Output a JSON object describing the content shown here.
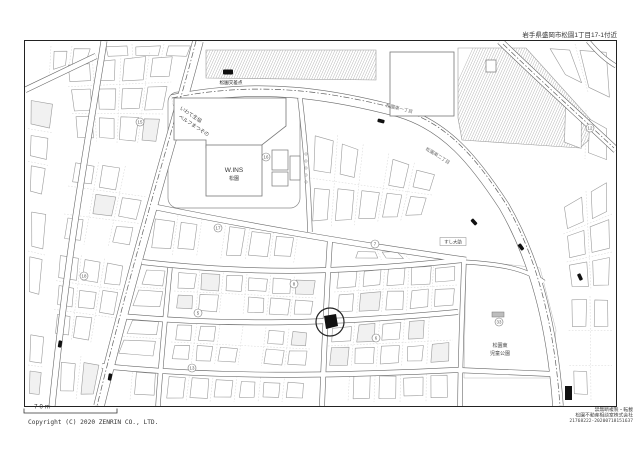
{
  "page": {
    "header_address": "岩手県盛岡市松園1丁目17-1付近",
    "scale_label": "70m",
    "copyright": "Copyright (C) 2020 ZENRIN CO., LTD.",
    "footer_right": {
      "line1": "禁無断複製・転載",
      "line2": "松園不動産相談室株式会社",
      "line3": "21768222-20200718151637"
    }
  },
  "map": {
    "colors": {
      "road_edge": "#686868",
      "building_outline": "#9b9b9b",
      "named_building_outline": "#777777",
      "lot_line": "#c9c9c9",
      "boundary_line": "#5f5f5f",
      "hatch": "#a8a8a8",
      "label_text": "#444444",
      "road_label_text": "#6b6b6b",
      "marker_black": "#111111",
      "frame": "#222222"
    },
    "labels": [
      {
        "id": "intersection-name",
        "text": "松園交差点",
        "x": 231,
        "y": 84,
        "size": 4.6,
        "rot": 0,
        "color": "#222222"
      },
      {
        "id": "coop-line1",
        "text": "いわて生協",
        "x": 190,
        "y": 116,
        "size": 5,
        "rot": 33,
        "color": "#444444"
      },
      {
        "id": "coop-line2",
        "text": "ベルフまつぞの",
        "x": 193,
        "y": 127,
        "size": 5,
        "rot": 33,
        "color": "#444444"
      },
      {
        "id": "wins-line1",
        "text": "W.INS",
        "x": 234,
        "y": 172,
        "size": 6.5,
        "rot": 0,
        "color": "#333333"
      },
      {
        "id": "wins-line2",
        "text": "松園",
        "x": 234,
        "y": 180,
        "size": 5,
        "rot": 0,
        "color": "#333333"
      },
      {
        "id": "road-name-1",
        "text": "松園東一丁目",
        "x": 399,
        "y": 110,
        "size": 4.6,
        "rot": 14,
        "color": "#6b6b6b"
      },
      {
        "id": "road-name-2",
        "text": "松園東二丁目",
        "x": 437,
        "y": 157,
        "size": 4.6,
        "rot": 32,
        "color": "#6b6b6b"
      },
      {
        "id": "sushi-daisuke",
        "text": "すし大助",
        "x": 453,
        "y": 243.5,
        "size": 4.4,
        "rot": 0,
        "color": "#333333",
        "boxed": true
      },
      {
        "id": "park-name-1",
        "text": "松園東",
        "x": 500,
        "y": 347,
        "size": 5,
        "rot": 0,
        "color": "#444444"
      },
      {
        "id": "park-name-2",
        "text": "児童公園",
        "x": 500,
        "y": 355,
        "size": 5,
        "rot": 0,
        "color": "#444444"
      }
    ],
    "block_numbers": [
      {
        "n": "15",
        "x": 140,
        "y": 122
      },
      {
        "n": "16",
        "x": 266,
        "y": 157
      },
      {
        "n": "17",
        "x": 218,
        "y": 228
      },
      {
        "n": "18",
        "x": 84,
        "y": 276
      },
      {
        "n": "7",
        "x": 375,
        "y": 244
      },
      {
        "n": "8",
        "x": 294,
        "y": 284
      },
      {
        "n": "5",
        "x": 198,
        "y": 313
      },
      {
        "n": "13",
        "x": 192,
        "y": 368
      },
      {
        "n": "33",
        "x": 499,
        "y": 322
      },
      {
        "n": "12",
        "x": 590,
        "y": 128
      },
      {
        "n": "6",
        "x": 376,
        "y": 338
      }
    ],
    "bus_stops": [
      {
        "x": 381,
        "y": 121,
        "rot": 14
      },
      {
        "x": 474,
        "y": 222,
        "rot": 48
      },
      {
        "x": 521,
        "y": 247,
        "rot": 55
      },
      {
        "x": 580,
        "y": 277,
        "rot": 65
      },
      {
        "x": 60,
        "y": 344,
        "rot": -80
      },
      {
        "x": 110,
        "y": 377,
        "rot": -80
      }
    ],
    "intersection_icon": {
      "x": 228,
      "y": 72
    },
    "target_marker": {
      "x": 330,
      "y": 322,
      "r": 14
    },
    "park_icon": {
      "x": 492,
      "y": 312,
      "w": 12,
      "h": 5
    },
    "black_building": {
      "x": 565,
      "y": 386,
      "w": 7,
      "h": 14
    }
  }
}
